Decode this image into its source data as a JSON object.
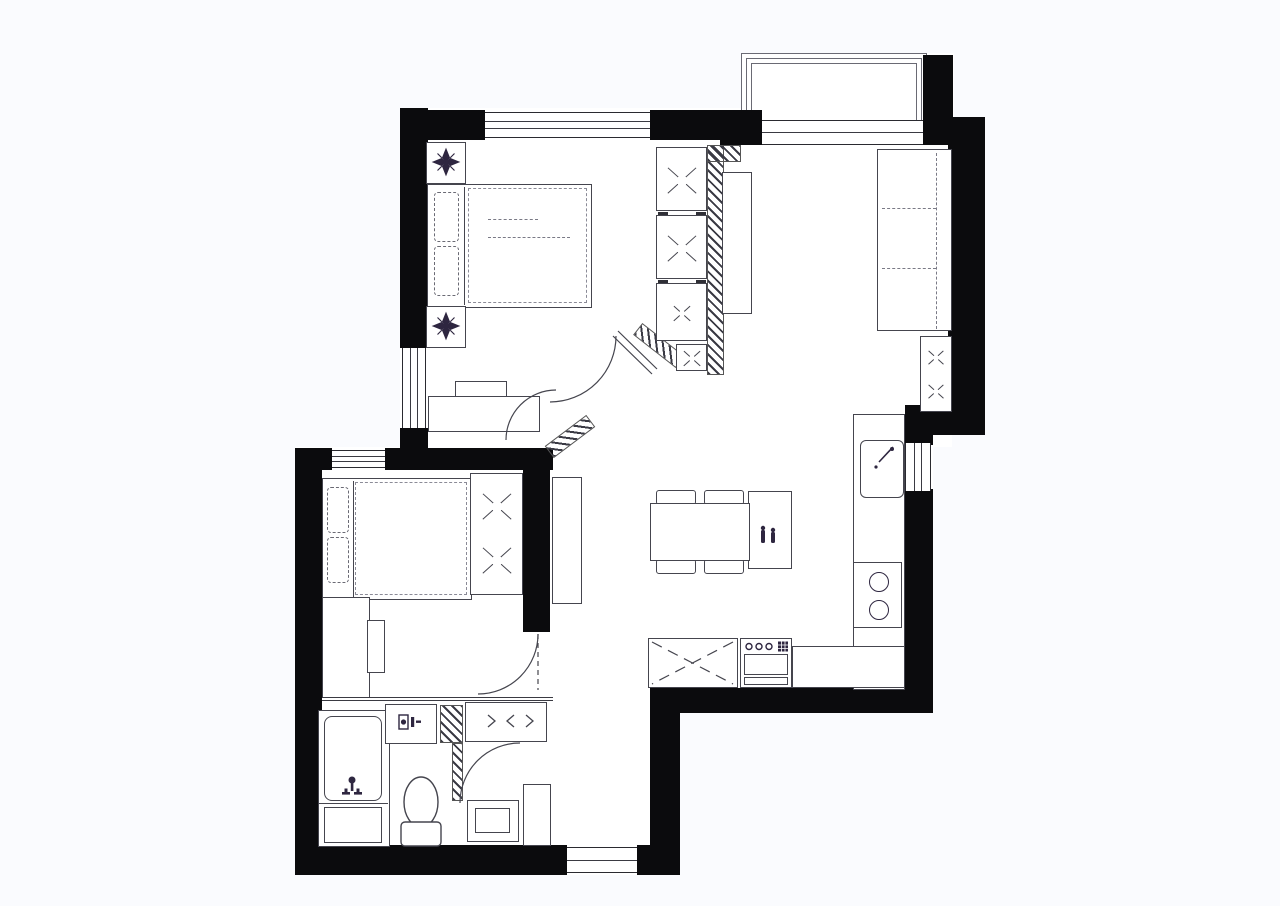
{
  "title": "apartment-floor-plan",
  "colors": {
    "bg": "#fafbfe",
    "floor": "#ffffff",
    "wall": "#0b0b0d",
    "line": "#45454e",
    "dark": "#2e2640",
    "hatch_color": "#3a3a44"
  },
  "plan": {
    "type": "2-bedroom apartment floor plan, top-down architectural drawing",
    "rooms": [
      "bedroom-1",
      "bedroom-2",
      "living-room",
      "kitchen",
      "dining-area",
      "bathroom",
      "hallway",
      "balcony"
    ],
    "door_count": 4,
    "window_count": 4,
    "furniture": {
      "double-bed": 2,
      "nightstand": 2,
      "plant": 2,
      "wardrobe-unit": 4,
      "wardrobe": 1,
      "sofa": 1,
      "tv-cabinet": 1,
      "side-cabinet": 1,
      "console": 1,
      "dining-table": 1,
      "dining-chair": 4,
      "bar-cabinet": 1,
      "kitchen-counter": 2,
      "sink": 1,
      "cooktop-burner": 2,
      "oven": 1,
      "refrigerator-cabinet": 1,
      "washing-machine": 1,
      "bathtub": 1,
      "toilet": 1,
      "shoe-cabinet": 1,
      "dresser": 1,
      "desk": 1,
      "chair": 1,
      "hall-cabinet": 2
    }
  },
  "icons": [
    "plant-icon",
    "bath-faucet-icon",
    "washing-machine-icon",
    "toilet-icon",
    "sink-faucet-icon",
    "burner-icon",
    "oven-knobs-icon",
    "bottles-icon",
    "chevron-icon",
    "x-mark-icon",
    "door-arc",
    "hatch-wall"
  ]
}
